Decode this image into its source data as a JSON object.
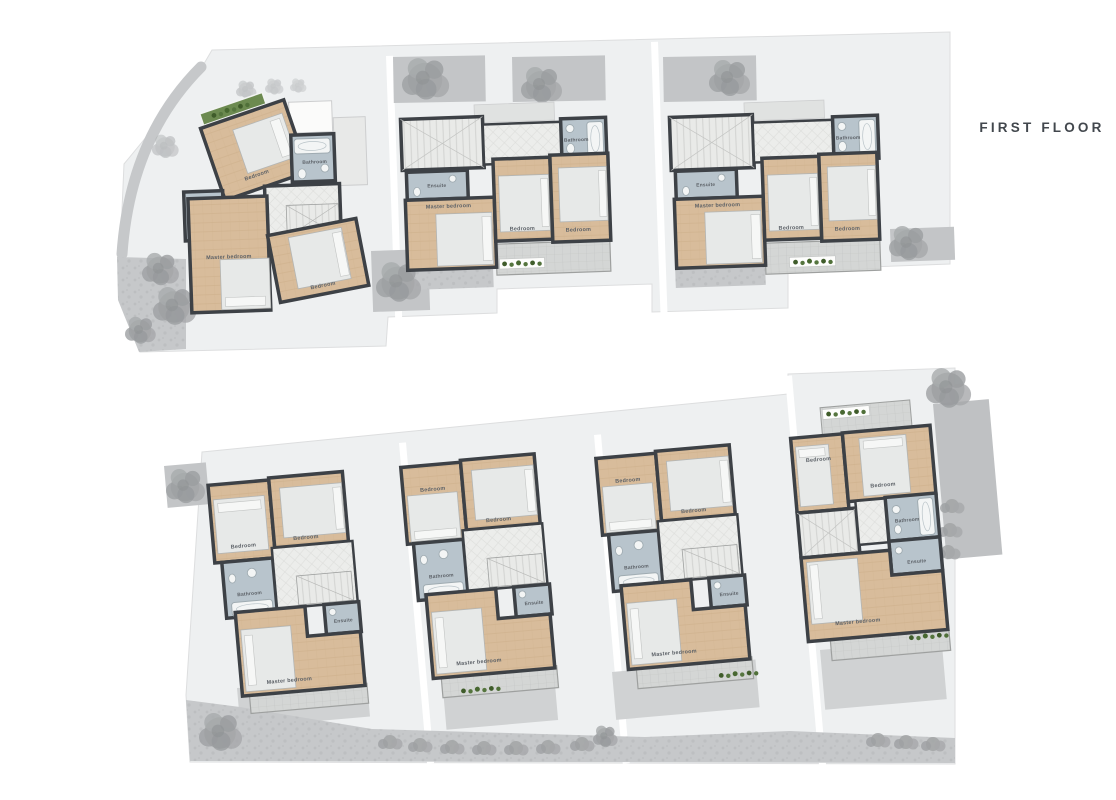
{
  "title": "FIRST FLOOR",
  "colors": {
    "wall": "#3d4146",
    "wood_floor": "#d8bc9b",
    "bathroom_floor": "#b8c4cc",
    "hall_tile": "#eaebe9",
    "parcel": "#eef0f1",
    "pavement": "#c6c8ca",
    "tree": "#9da0a2",
    "plants": "#55753e",
    "bed": "#e7e9e8",
    "label": "#5c6167",
    "title_text": "#42474d"
  },
  "units": [
    {
      "name": "villa-1",
      "rooms": {
        "bedroom_1": "Bedroom",
        "bathroom": "Bathroom",
        "ensuite": "Ensuite",
        "master_bedroom": "Master bedroom",
        "bedroom_2": "Bedroom"
      }
    },
    {
      "name": "villa-2",
      "rooms": {
        "bedroom_1": "Bedroom",
        "bathroom": "Bathroom",
        "ensuite": "Ensuite",
        "master_bedroom": "Master bedroom",
        "bedroom_2": "Bedroom"
      }
    },
    {
      "name": "villa-3",
      "rooms": {
        "bedroom_1": "Bedroom",
        "bathroom": "Bathroom",
        "ensuite": "Ensuite",
        "master_bedroom": "Master bedroom",
        "bedroom_2": "Bedroom"
      }
    },
    {
      "name": "villa-4",
      "rooms": {
        "bedroom_1": "Bedroom",
        "bathroom": "Bathroom",
        "ensuite": "Ensuite",
        "master_bedroom": "Master bedroom",
        "bedroom_2": "Bedroom"
      }
    },
    {
      "name": "villa-5",
      "rooms": {
        "bedroom_1": "Bedroom",
        "bathroom": "Bathroom",
        "ensuite": "Ensuite",
        "master_bedroom": "Master bedroom",
        "bedroom_2": "Bedroom"
      }
    },
    {
      "name": "villa-6",
      "rooms": {
        "bedroom_1": "Bedroom",
        "bathroom": "Bathroom",
        "ensuite": "Ensuite",
        "master_bedroom": "Master bedroom",
        "bedroom_2": "Bedroom"
      }
    },
    {
      "name": "villa-7",
      "rooms": {
        "bedroom_1": "Bedroom",
        "bathroom": "Bathroom",
        "ensuite": "Ensuite",
        "master_bedroom": "Master bedroom",
        "bedroom_2": "Bedroom"
      }
    }
  ]
}
